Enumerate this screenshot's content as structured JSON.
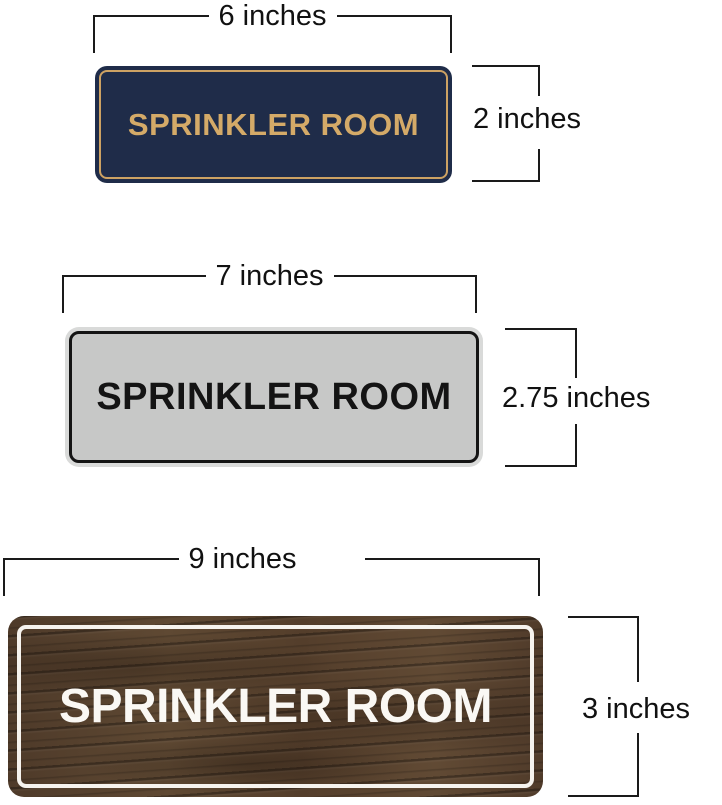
{
  "canvas": {
    "background": "#ffffff"
  },
  "signs": [
    {
      "name": "navy-gold-sign",
      "text": "SPRINKLER ROOM",
      "bg_color": "#1f2c49",
      "border_color": "#cda263",
      "text_color": "#d4aa68",
      "width_label": "6 inches",
      "height_label": "2 inches"
    },
    {
      "name": "silver-black-sign",
      "text": "SPRINKLER ROOM",
      "rim_color": "#d9dad9",
      "bg_color": "#c7c8c7",
      "border_color": "#141414",
      "text_color": "#141414",
      "width_label": "7 inches",
      "height_label": "2.75 inches"
    },
    {
      "name": "walnut-wood-sign",
      "text": "SPRINKLER ROOM",
      "bg_color": "#563f2d",
      "border_color": "#f6f3ee",
      "text_color": "#faf8f4",
      "width_label": "9 inches",
      "height_label": "3 inches"
    }
  ],
  "annotation": {
    "line_color": "#1a1a1a",
    "label_color": "#111111"
  }
}
